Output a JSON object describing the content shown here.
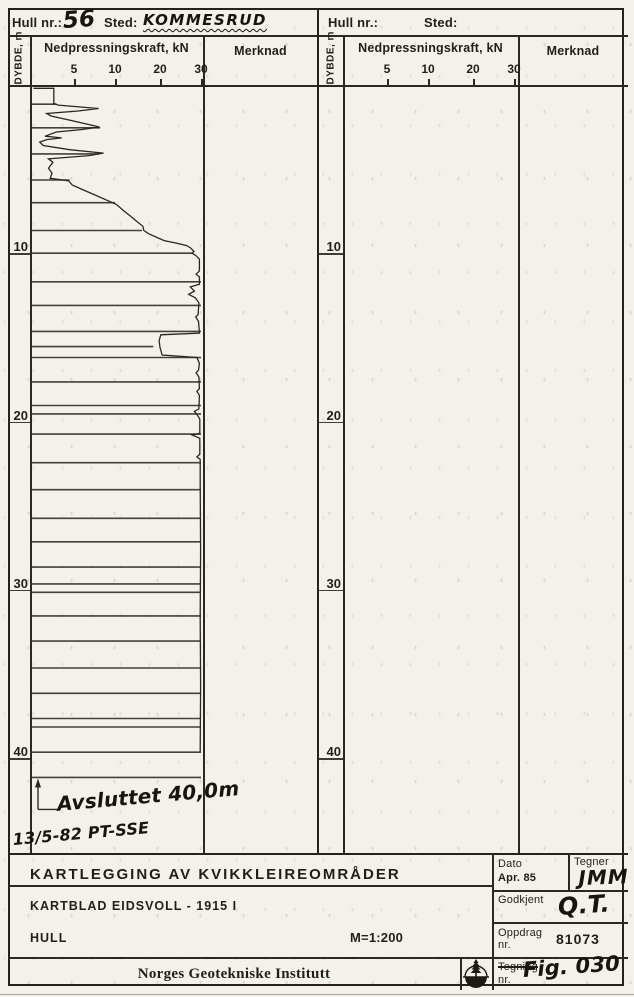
{
  "page": {
    "bg": "#f3f1ea",
    "ink": "#211f1b"
  },
  "panels": [
    {
      "hull_label": "Hull nr.:",
      "hull_value": "56",
      "sted_label": "Sted:",
      "sted_value": "KOMMESRUD",
      "depth_col_label": "DYBDE, m",
      "force_header": "Nedpressningskraft, kN",
      "force_ticks": [
        "5",
        "10",
        "20",
        "30"
      ],
      "merknad_header": "Merknad",
      "depth_marks": [
        "10",
        "20",
        "30",
        "40"
      ]
    },
    {
      "hull_label": "Hull nr.:",
      "hull_value": "",
      "sted_label": "Sted:",
      "sted_value": "",
      "depth_col_label": "DYBDE, m",
      "force_header": "Nedpressningskraft, kN",
      "force_ticks": [
        "5",
        "10",
        "20",
        "30"
      ],
      "merknad_header": "Merknad",
      "depth_marks": [
        "10",
        "20",
        "30",
        "40"
      ]
    }
  ],
  "handwriting": {
    "terminated": "Avsluttet 40,0m",
    "signoff": "13/5-82 PT-SSE"
  },
  "title_block": {
    "project_title": "KARTLEGGING AV KVIKKLEIREOMRÅDER",
    "map_sheet": "KARTBLAD EIDSVOLL - 1915 I",
    "hole_label": "HULL",
    "scale": "M=1:200",
    "institute": "Norges Geotekniske Institutt",
    "date_label": "Dato",
    "date_value": "Apr. 85",
    "drafter_label": "Tegner",
    "drafter_value": "JMM",
    "approved_label": "Godkjent",
    "approved_value": "Q.T.",
    "project_no_label": "Oppdrag",
    "project_no_label2": "nr.",
    "project_no_value": "81073",
    "drawing_no_label": "Tegning",
    "drawing_no_label2": "nr.",
    "drawing_no_value": "Fig. 030",
    "logo_name": "ngi-tree-logo"
  },
  "chart_data": {
    "type": "line",
    "title": "Hull nr. 56 – Sted: Kommesrud",
    "xlabel": "Nedpressningskraft, kN",
    "ylabel": "DYBDE, m",
    "x_ticks": [
      5,
      10,
      20,
      30
    ],
    "x_scale_note": "ticks 5,10,20,30 equally spaced (non-linear kN scale), 0 at left edge",
    "ylim": [
      0,
      46
    ],
    "depth_grid_labels": [
      10,
      20,
      30,
      40
    ],
    "termination_depth_m": 40.0,
    "termination_note_line_depth_m": 41.5,
    "series": [
      {
        "name": "Nedpressningskraft hull 56",
        "points": [
          [
            0.55,
            0.4
          ],
          [
            0.55,
            2.7
          ],
          [
            1.45,
            2.7
          ],
          [
            1.55,
            3.2
          ],
          [
            1.75,
            8.0
          ],
          [
            1.9,
            5.5
          ],
          [
            2.05,
            1.9
          ],
          [
            2.2,
            2.4
          ],
          [
            2.5,
            5.0
          ],
          [
            2.85,
            8.1
          ],
          [
            3.0,
            6.0
          ],
          [
            3.15,
            3.0
          ],
          [
            3.4,
            1.7
          ],
          [
            3.5,
            3.6
          ],
          [
            3.6,
            1.9
          ],
          [
            3.75,
            1.1
          ],
          [
            3.95,
            1.5
          ],
          [
            4.2,
            4.5
          ],
          [
            4.4,
            8.6
          ],
          [
            4.55,
            6.8
          ],
          [
            4.75,
            2.1
          ],
          [
            4.95,
            2.6
          ],
          [
            5.3,
            2.1
          ],
          [
            5.6,
            2.5
          ],
          [
            5.9,
            2.3
          ],
          [
            6.05,
            4.4
          ],
          [
            6.3,
            4.8
          ],
          [
            6.6,
            6.2
          ],
          [
            6.9,
            7.6
          ],
          [
            7.2,
            9.0
          ],
          [
            7.45,
            10.3
          ],
          [
            7.8,
            11.8
          ],
          [
            8.1,
            13.2
          ],
          [
            8.45,
            14.8
          ],
          [
            8.75,
            16.2
          ],
          [
            9.0,
            16.4
          ],
          [
            9.2,
            17.5
          ],
          [
            9.45,
            19.6
          ],
          [
            9.6,
            21.0
          ],
          [
            9.75,
            24.0
          ],
          [
            9.9,
            26.5
          ],
          [
            10.05,
            27.5
          ],
          [
            10.25,
            28.3
          ],
          [
            10.35,
            27.8
          ],
          [
            10.5,
            28.8
          ],
          [
            10.7,
            29.6
          ],
          [
            11.4,
            29.6
          ],
          [
            11.6,
            28.8
          ],
          [
            11.75,
            29.6
          ],
          [
            12.2,
            29.6
          ],
          [
            12.35,
            27.4
          ],
          [
            12.6,
            28.4
          ],
          [
            12.8,
            27.0
          ],
          [
            13.0,
            28.6
          ],
          [
            13.3,
            29.5
          ],
          [
            14.0,
            29.3
          ],
          [
            14.15,
            28.7
          ],
          [
            14.4,
            29.4
          ],
          [
            15.1,
            29.6
          ],
          [
            15.2,
            20.2
          ],
          [
            15.55,
            19.8
          ],
          [
            15.95,
            20.0
          ],
          [
            16.4,
            20.5
          ],
          [
            16.55,
            29.0
          ],
          [
            16.9,
            29.6
          ],
          [
            17.3,
            29.4
          ],
          [
            17.45,
            28.8
          ],
          [
            17.7,
            29.5
          ],
          [
            18.4,
            29.6
          ],
          [
            18.55,
            29.0
          ],
          [
            18.8,
            29.6
          ],
          [
            19.6,
            29.5
          ],
          [
            19.75,
            28.4
          ],
          [
            20.0,
            29.2
          ],
          [
            20.2,
            29.7
          ],
          [
            21.05,
            29.7
          ],
          [
            21.15,
            27.8
          ],
          [
            21.35,
            29.7
          ],
          [
            22.3,
            29.7
          ],
          [
            22.45,
            29.0
          ],
          [
            22.6,
            29.8
          ],
          [
            24.0,
            29.8
          ],
          [
            28.0,
            29.9
          ],
          [
            32.0,
            29.8
          ],
          [
            36.0,
            29.9
          ],
          [
            40.0,
            29.8
          ]
        ]
      }
    ],
    "marker_lines": [
      [
        1.5,
        3.0
      ],
      [
        2.9,
        8.2
      ],
      [
        4.45,
        8.0
      ],
      [
        6.0,
        4.5
      ],
      [
        7.35,
        10.0
      ],
      [
        9.0,
        16.0
      ],
      [
        10.35,
        28.0
      ],
      [
        12.05,
        30
      ],
      [
        13.45,
        30
      ],
      [
        15.0,
        30
      ],
      [
        15.9,
        18.5
      ],
      [
        16.55,
        30
      ],
      [
        18.0,
        30
      ],
      [
        19.4,
        30
      ],
      [
        19.9,
        30
      ],
      [
        21.1,
        30
      ],
      [
        22.8,
        30
      ],
      [
        24.4,
        30
      ],
      [
        26.1,
        30
      ],
      [
        27.5,
        30
      ],
      [
        29.0,
        30
      ],
      [
        30.0,
        30
      ],
      [
        30.5,
        30
      ],
      [
        31.9,
        30
      ],
      [
        33.4,
        30
      ],
      [
        35.0,
        30
      ],
      [
        36.5,
        30
      ],
      [
        38.0,
        30
      ],
      [
        38.5,
        30
      ],
      [
        40.0,
        30
      ],
      [
        41.5,
        30
      ]
    ]
  }
}
